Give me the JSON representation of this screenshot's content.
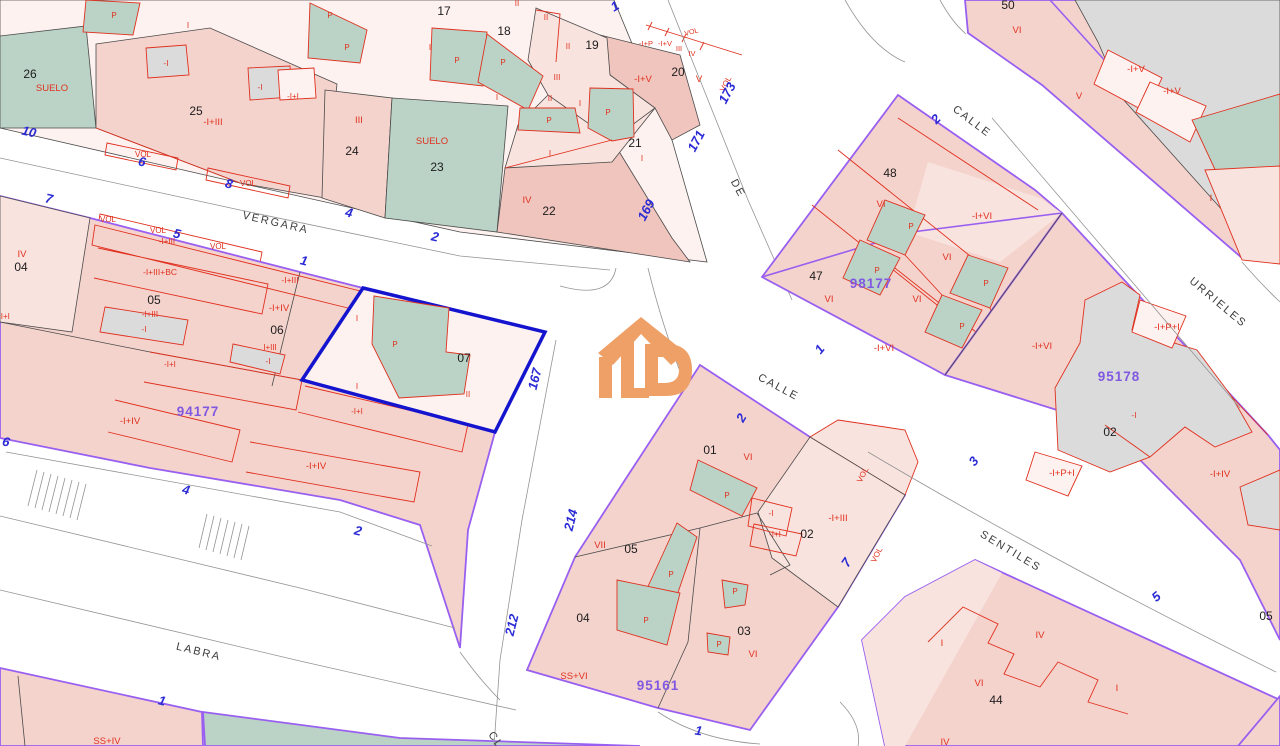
{
  "map": {
    "type": "cadastral-parcel-map",
    "selected_parcel": {
      "parcel": "07",
      "block": "94177"
    },
    "street_names": [
      {
        "t": "VERGARA",
        "x": 275,
        "y": 226,
        "r": 13
      },
      {
        "t": "LABRA",
        "x": 198,
        "y": 655,
        "r": 14
      },
      {
        "t": "DE",
        "x": 735,
        "y": 190,
        "r": 62
      },
      {
        "t": "CALLE",
        "x": 970,
        "y": 124,
        "r": 37
      },
      {
        "t": "URRIELES",
        "x": 1216,
        "y": 305,
        "r": 40
      },
      {
        "t": "CALLE",
        "x": 777,
        "y": 390,
        "r": 28
      },
      {
        "t": "SENTILES",
        "x": 1009,
        "y": 554,
        "r": 31
      },
      {
        "t": "CL",
        "x": 493,
        "y": 742,
        "r": 55
      }
    ],
    "house_numbers": [
      {
        "t": "10",
        "x": 28,
        "y": 136,
        "r": 13
      },
      {
        "t": "6",
        "x": 141,
        "y": 166,
        "r": 13
      },
      {
        "t": "8",
        "x": 228,
        "y": 188,
        "r": 13
      },
      {
        "t": "7",
        "x": 48,
        "y": 203,
        "r": 13
      },
      {
        "t": "5",
        "x": 176,
        "y": 238,
        "r": 13
      },
      {
        "t": "1",
        "x": 303,
        "y": 265,
        "r": 13
      },
      {
        "t": "4",
        "x": 348,
        "y": 217,
        "r": 13
      },
      {
        "t": "2",
        "x": 434,
        "y": 241,
        "r": 13
      },
      {
        "t": "1",
        "x": 617,
        "y": 10,
        "r": -30
      },
      {
        "t": "173",
        "x": 731,
        "y": 95,
        "r": -62
      },
      {
        "t": "171",
        "x": 700,
        "y": 143,
        "r": -62
      },
      {
        "t": "169",
        "x": 650,
        "y": 212,
        "r": -62
      },
      {
        "t": "167",
        "x": 539,
        "y": 380,
        "r": -76
      },
      {
        "t": "214",
        "x": 575,
        "y": 521,
        "r": -76
      },
      {
        "t": "212",
        "x": 516,
        "y": 626,
        "r": -76
      },
      {
        "t": "2",
        "x": 939,
        "y": 122,
        "r": -45
      },
      {
        "t": "1",
        "x": 823,
        "y": 352,
        "r": -50
      },
      {
        "t": "3",
        "x": 977,
        "y": 464,
        "r": -50
      },
      {
        "t": "2",
        "x": 745,
        "y": 420,
        "r": -60
      },
      {
        "t": "7",
        "x": 850,
        "y": 565,
        "r": -55
      },
      {
        "t": "5",
        "x": 1159,
        "y": 600,
        "r": -40
      },
      {
        "t": "6",
        "x": 5,
        "y": 446,
        "r": 14
      },
      {
        "t": "4",
        "x": 185,
        "y": 494,
        "r": 14
      },
      {
        "t": "2",
        "x": 357,
        "y": 535,
        "r": 14
      },
      {
        "t": "1",
        "x": 161,
        "y": 705,
        "r": 14
      },
      {
        "t": "1",
        "x": 698,
        "y": 735,
        "r": 8
      }
    ],
    "block_codes": [
      {
        "t": "94177",
        "x": 198,
        "y": 416
      },
      {
        "t": "95161",
        "x": 658,
        "y": 690
      },
      {
        "t": "95178",
        "x": 1119,
        "y": 381
      },
      {
        "t": "98177",
        "x": 871,
        "y": 288
      }
    ],
    "parcel_numbers": [
      {
        "t": "26",
        "x": 30,
        "y": 78
      },
      {
        "t": "25",
        "x": 196,
        "y": 115
      },
      {
        "t": "24",
        "x": 352,
        "y": 155
      },
      {
        "t": "23",
        "x": 437,
        "y": 171
      },
      {
        "t": "22",
        "x": 549,
        "y": 215
      },
      {
        "t": "21",
        "x": 635,
        "y": 147
      },
      {
        "t": "20",
        "x": 678,
        "y": 76
      },
      {
        "t": "19",
        "x": 592,
        "y": 49
      },
      {
        "t": "18",
        "x": 504,
        "y": 35
      },
      {
        "t": "17",
        "x": 444,
        "y": 15
      },
      {
        "t": "04",
        "x": 21,
        "y": 271
      },
      {
        "t": "05",
        "x": 154,
        "y": 304
      },
      {
        "t": "06",
        "x": 277,
        "y": 334
      },
      {
        "t": "07",
        "x": 464,
        "y": 362
      },
      {
        "t": "48",
        "x": 890,
        "y": 177
      },
      {
        "t": "47",
        "x": 816,
        "y": 280
      },
      {
        "t": "50",
        "x": 1008,
        "y": 9
      },
      {
        "t": "01",
        "x": 710,
        "y": 454
      },
      {
        "t": "02",
        "x": 807,
        "y": 538
      },
      {
        "t": "05",
        "x": 631,
        "y": 553
      },
      {
        "t": "04",
        "x": 583,
        "y": 622
      },
      {
        "t": "03",
        "x": 744,
        "y": 635
      },
      {
        "t": "02",
        "x": 1110,
        "y": 436
      },
      {
        "t": "44",
        "x": 996,
        "y": 704
      },
      {
        "t": "05",
        "x": 1266,
        "y": 620
      }
    ],
    "construction_labels": [
      {
        "t": "SUELO",
        "x": 52,
        "y": 91
      },
      {
        "t": "-I",
        "x": 166,
        "y": 66,
        "s": 8
      },
      {
        "t": "-I",
        "x": 260,
        "y": 90,
        "s": 8
      },
      {
        "t": "-I+I",
        "x": 293,
        "y": 99,
        "s": 8
      },
      {
        "t": "-I+III",
        "x": 213,
        "y": 125
      },
      {
        "t": "III",
        "x": 359,
        "y": 123
      },
      {
        "t": "SUELO",
        "x": 432,
        "y": 144
      },
      {
        "t": "IV",
        "x": 527,
        "y": 203
      },
      {
        "t": "I",
        "x": 188,
        "y": 28,
        "s": 8
      },
      {
        "t": "P",
        "x": 114,
        "y": 18,
        "s": 8
      },
      {
        "t": "P",
        "x": 330,
        "y": 18,
        "s": 8
      },
      {
        "t": "P",
        "x": 347,
        "y": 50,
        "s": 8
      },
      {
        "t": "I",
        "x": 430,
        "y": 50,
        "s": 8
      },
      {
        "t": "I",
        "x": 497,
        "y": 100,
        "s": 8
      },
      {
        "t": "II",
        "x": 517,
        "y": 6,
        "s": 8
      },
      {
        "t": "II",
        "x": 546,
        "y": 20,
        "s": 8
      },
      {
        "t": "II",
        "x": 568,
        "y": 49,
        "s": 8
      },
      {
        "t": "III",
        "x": 557,
        "y": 80,
        "s": 8
      },
      {
        "t": "II",
        "x": 550,
        "y": 101,
        "s": 8
      },
      {
        "t": "I",
        "x": 580,
        "y": 106,
        "s": 8
      },
      {
        "t": "P",
        "x": 457,
        "y": 63,
        "s": 8
      },
      {
        "t": "P",
        "x": 503,
        "y": 65,
        "s": 8
      },
      {
        "t": "P",
        "x": 549,
        "y": 123,
        "s": 8
      },
      {
        "t": "P",
        "x": 608,
        "y": 115,
        "s": 8
      },
      {
        "t": "I",
        "x": 550,
        "y": 156,
        "s": 8
      },
      {
        "t": "I",
        "x": 642,
        "y": 161,
        "s": 8
      },
      {
        "t": "-I+P",
        "x": 646,
        "y": 46,
        "s": 7.5
      },
      {
        "t": "-I+V",
        "x": 665,
        "y": 46,
        "s": 7.5
      },
      {
        "t": "III",
        "x": 679,
        "y": 51,
        "s": 7.5
      },
      {
        "t": "IV",
        "x": 692,
        "y": 56,
        "s": 7.5
      },
      {
        "t": "-I+V",
        "x": 643,
        "y": 82
      },
      {
        "t": "V",
        "x": 699,
        "y": 82
      },
      {
        "t": "VOL",
        "x": 728,
        "y": 85,
        "r": -62,
        "s": 8
      },
      {
        "t": "VOL",
        "x": 692,
        "y": 34,
        "r": -15,
        "s": 7
      },
      {
        "t": "VOL",
        "x": 143,
        "y": 157,
        "s": 8
      },
      {
        "t": "VOL",
        "x": 248,
        "y": 186,
        "s": 8
      },
      {
        "t": "VOL",
        "x": 108,
        "y": 222,
        "s": 8
      },
      {
        "t": "VOL",
        "x": 158,
        "y": 233,
        "s": 8
      },
      {
        "t": "-I+III",
        "x": 167,
        "y": 244,
        "s": 8
      },
      {
        "t": "VOL",
        "x": 218,
        "y": 249,
        "s": 8
      },
      {
        "t": "IV",
        "x": 22,
        "y": 257
      },
      {
        "t": "-I+I",
        "x": 4,
        "y": 319,
        "s": 8
      },
      {
        "t": "-I+III+BC",
        "x": 160,
        "y": 275,
        "s": 8.5
      },
      {
        "t": "-I+III",
        "x": 150,
        "y": 317,
        "s": 8
      },
      {
        "t": "-I",
        "x": 144,
        "y": 332,
        "s": 8
      },
      {
        "t": "-I+III",
        "x": 290,
        "y": 283,
        "s": 8.5
      },
      {
        "t": "-I+IV",
        "x": 279,
        "y": 311
      },
      {
        "t": "I+III",
        "x": 270,
        "y": 350,
        "s": 8
      },
      {
        "t": "-I",
        "x": 268,
        "y": 364,
        "s": 8
      },
      {
        "t": "-I+I",
        "x": 170,
        "y": 367,
        "s": 8
      },
      {
        "t": "I",
        "x": 357,
        "y": 321,
        "s": 8
      },
      {
        "t": "P",
        "x": 395,
        "y": 347,
        "s": 8
      },
      {
        "t": "I",
        "x": 357,
        "y": 389,
        "s": 8
      },
      {
        "t": "II",
        "x": 468,
        "y": 397,
        "s": 8
      },
      {
        "t": "-I+I",
        "x": 357,
        "y": 414,
        "s": 8
      },
      {
        "t": "-I+IV",
        "x": 130,
        "y": 424
      },
      {
        "t": "-I+IV",
        "x": 316,
        "y": 469
      },
      {
        "t": "SS+IV",
        "x": 107,
        "y": 744
      },
      {
        "t": "VI",
        "x": 748,
        "y": 460
      },
      {
        "t": "P",
        "x": 727,
        "y": 498,
        "s": 8
      },
      {
        "t": "-I",
        "x": 771,
        "y": 516,
        "s": 8
      },
      {
        "t": "-I+I",
        "x": 775,
        "y": 537,
        "s": 8
      },
      {
        "t": "-I+III",
        "x": 838,
        "y": 521
      },
      {
        "t": "VOL",
        "x": 865,
        "y": 476,
        "r": -62,
        "s": 8
      },
      {
        "t": "VOL",
        "x": 879,
        "y": 556,
        "r": -62,
        "s": 8
      },
      {
        "t": "VII",
        "x": 600,
        "y": 548
      },
      {
        "t": "P",
        "x": 671,
        "y": 577,
        "s": 8
      },
      {
        "t": "P",
        "x": 646,
        "y": 623,
        "s": 8
      },
      {
        "t": "P",
        "x": 735,
        "y": 594,
        "s": 8
      },
      {
        "t": "P",
        "x": 719,
        "y": 647,
        "s": 8
      },
      {
        "t": "VI",
        "x": 753,
        "y": 657
      },
      {
        "t": "SS+VI",
        "x": 574,
        "y": 679
      },
      {
        "t": "VI",
        "x": 881,
        "y": 207
      },
      {
        "t": "P",
        "x": 911,
        "y": 229,
        "s": 8
      },
      {
        "t": "-I+VI",
        "x": 982,
        "y": 219
      },
      {
        "t": "VI",
        "x": 947,
        "y": 260
      },
      {
        "t": "P",
        "x": 877,
        "y": 273,
        "s": 8
      },
      {
        "t": "VI",
        "x": 829,
        "y": 302
      },
      {
        "t": "VI",
        "x": 917,
        "y": 302
      },
      {
        "t": "P",
        "x": 986,
        "y": 286,
        "s": 8
      },
      {
        "t": "P",
        "x": 962,
        "y": 329,
        "s": 8
      },
      {
        "t": "-I+VI",
        "x": 884,
        "y": 351
      },
      {
        "t": "-I+VI",
        "x": 1042,
        "y": 349
      },
      {
        "t": "-I+P+I",
        "x": 1167,
        "y": 330
      },
      {
        "t": "-I",
        "x": 1134,
        "y": 418,
        "s": 8
      },
      {
        "t": "-I+P+I",
        "x": 1062,
        "y": 476
      },
      {
        "t": "-I+IV",
        "x": 1220,
        "y": 477
      },
      {
        "t": "VI",
        "x": 1017,
        "y": 33
      },
      {
        "t": "-I+V",
        "x": 1136,
        "y": 72
      },
      {
        "t": "-I+V",
        "x": 1172,
        "y": 94
      },
      {
        "t": "V",
        "x": 1079,
        "y": 99
      },
      {
        "t": "I",
        "x": 1211,
        "y": 201
      },
      {
        "t": "I",
        "x": 942,
        "y": 646
      },
      {
        "t": "IV",
        "x": 1040,
        "y": 638
      },
      {
        "t": "VI",
        "x": 979,
        "y": 686
      },
      {
        "t": "I",
        "x": 1117,
        "y": 691
      },
      {
        "t": "IV",
        "x": 945,
        "y": 745
      }
    ],
    "colors": {
      "parcel_pink": "#f5d3cd",
      "parcel_pink_light": "#f9e3df",
      "parcel_pink_pale": "#fdf2f0",
      "parcel_pink_dark": "#f0c5be",
      "courtyard_green": "#bad3c6",
      "building_gray": "#dbdbdb",
      "boundary_purple": "#995ff0",
      "selection_blue": "#1414cf",
      "construction_red": "#e0301e",
      "number_blue": "#2b2bd6",
      "code_purple": "#8059e0",
      "logo_orange": "#efa066"
    },
    "logo": {
      "name": "catastro-logo",
      "color": "#efa066"
    }
  }
}
